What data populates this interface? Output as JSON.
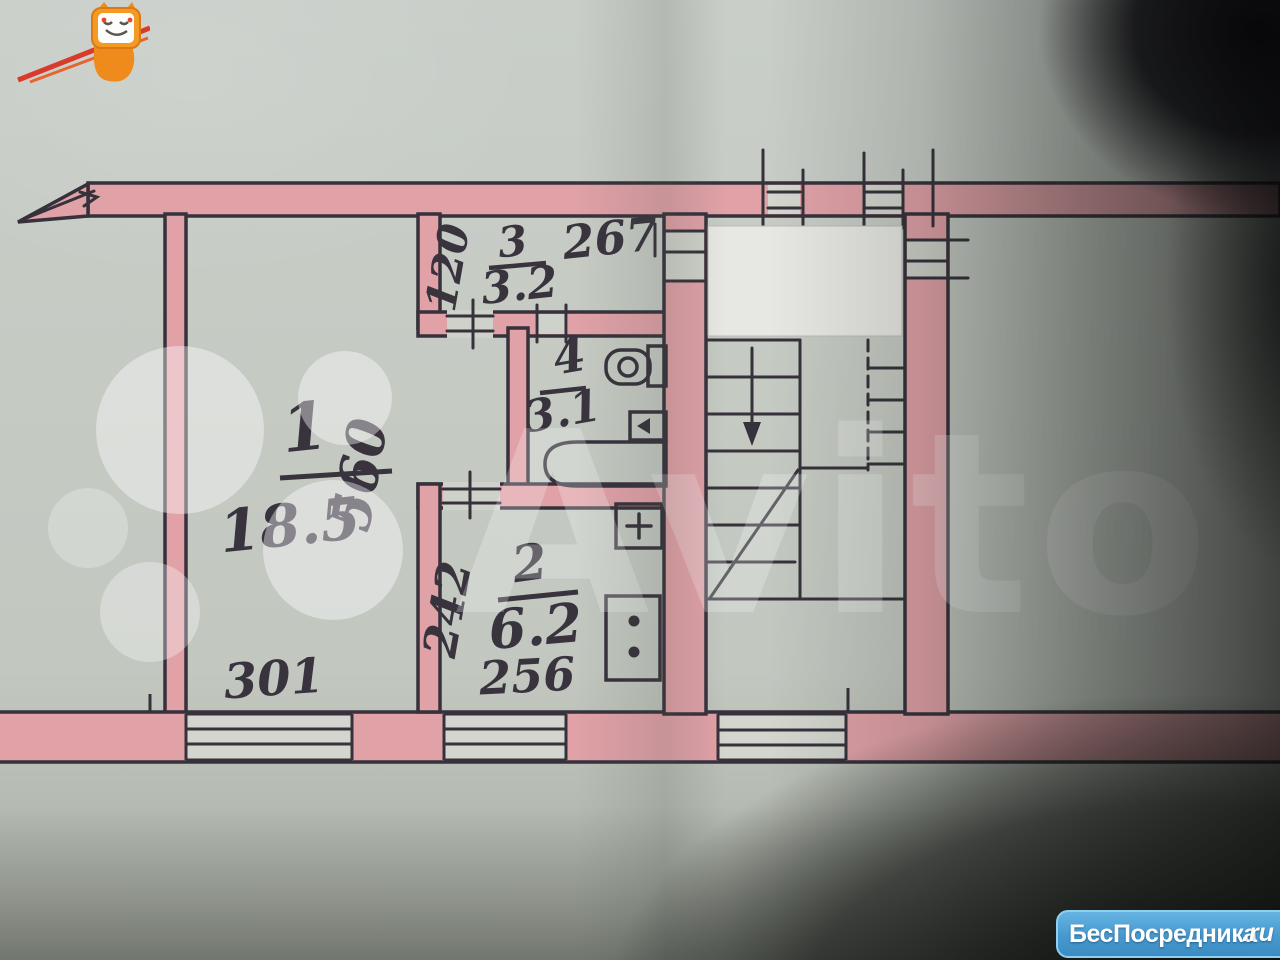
{
  "photo": {
    "watermark_text": "Avito",
    "logo": {
      "brand": "БесПосредника",
      "domain_suffix": ".ru"
    }
  },
  "plan": {
    "rooms": [
      {
        "number": "1",
        "area": "18.5"
      },
      {
        "number": "2",
        "area": "6.2"
      },
      {
        "number": "3",
        "area": "3.2"
      },
      {
        "number": "4",
        "area": "3.1"
      }
    ],
    "dimensions": {
      "room1_width": "301",
      "room1_height": "560",
      "room2_width": "256",
      "room2_height": "242",
      "hall_width": "267",
      "hall_height": "120"
    },
    "colors": {
      "paper": "#c6cbc4",
      "wall_fill": "#e0a1a7",
      "ink": "#36313b"
    }
  }
}
